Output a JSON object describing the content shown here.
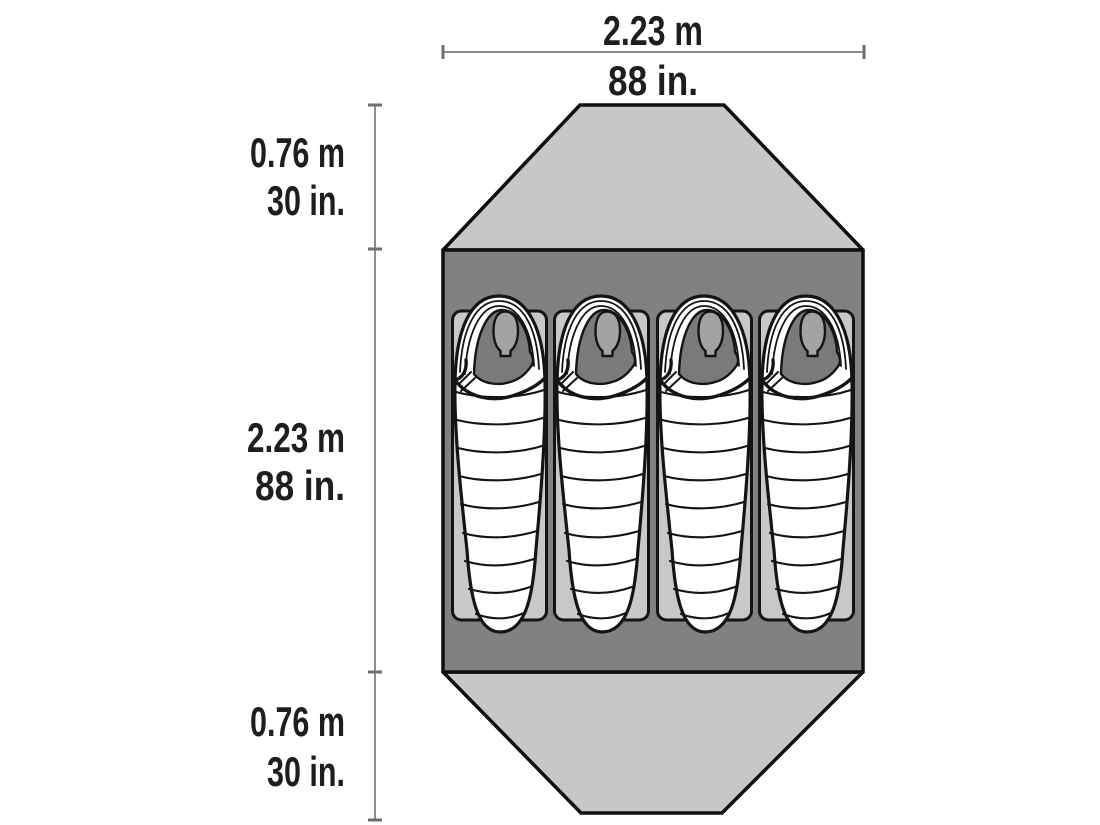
{
  "title": "Tent floor plan with dimensions",
  "colors": {
    "background": "#ffffff",
    "vestibule_fill": "#c7c7c7",
    "body_fill": "#818181",
    "pad_fill": "#c8c8c8",
    "bag_fill": "#ffffff",
    "face_fill": "#a3a3a3",
    "hood_interior_fill": "#7a7a7a",
    "outline": "#0f0f0f",
    "dimension_line": "#8c8c8c",
    "text": "#1e1e1e"
  },
  "dimensions": {
    "width": {
      "metric": "2.23 m",
      "imperial": "88 in."
    },
    "length": {
      "metric": "2.23 m",
      "imperial": "88 in."
    },
    "front_vestibule_depth": {
      "metric": "0.76 m",
      "imperial": "30 in."
    },
    "rear_vestibule_depth": {
      "metric": "0.76 m",
      "imperial": "30 in."
    }
  },
  "diagram": {
    "type": "tent-floor-plan-top-view",
    "sleeping_bag_count": 4
  }
}
